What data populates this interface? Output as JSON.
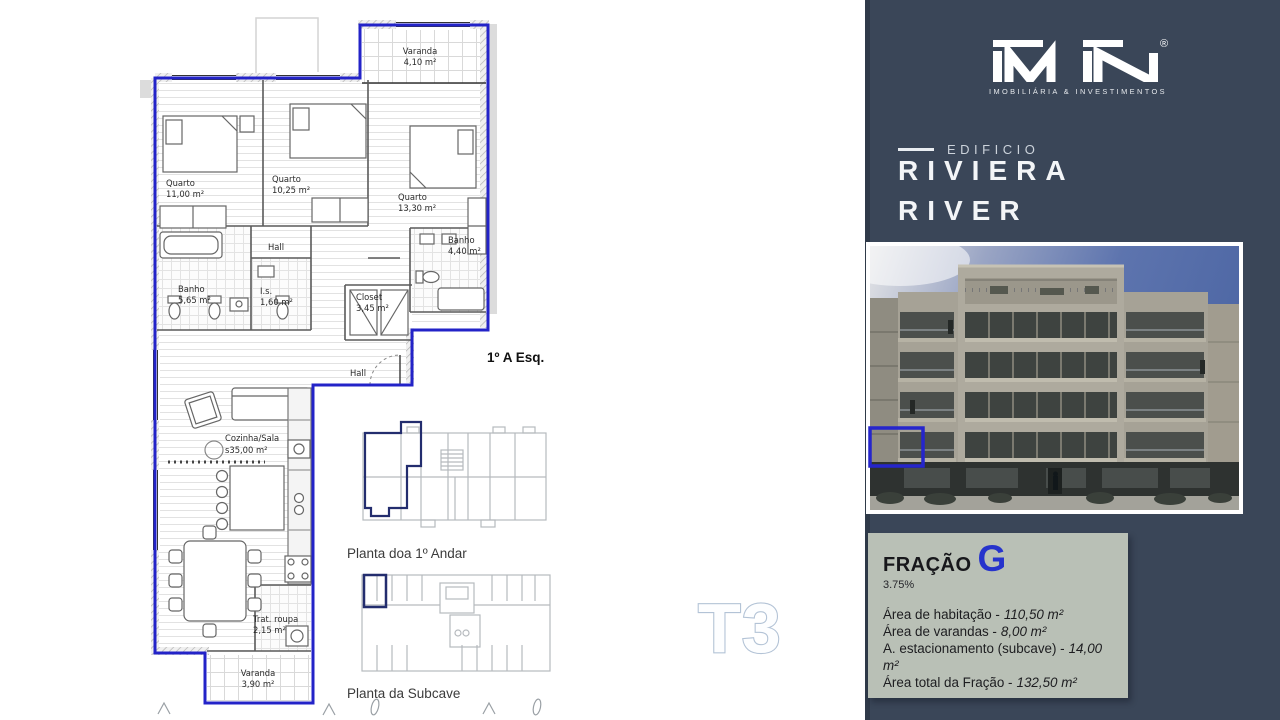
{
  "brand": {
    "logo_text": "iMiN",
    "registered_mark": "®",
    "tagline": "IMOBILIÁRIA & INVESTIMENTOS"
  },
  "building": {
    "label_prefix": "EDIFICIO",
    "name_line1": "RIVIERA",
    "name_line2": "RIVER"
  },
  "floor_plan": {
    "unit_label": "1º A Esq.",
    "type_watermark": "T3",
    "rooms": [
      {
        "name": "Varanda",
        "area": "4,10 m²"
      },
      {
        "name": "Quarto",
        "area": "11,00 m²"
      },
      {
        "name": "Quarto",
        "area": "10,25 m²"
      },
      {
        "name": "Quarto",
        "area": "13,30 m²"
      },
      {
        "name": "Hall",
        "area": ""
      },
      {
        "name": "Banho",
        "area": "4,40 m²"
      },
      {
        "name": "Banho",
        "area": "5,65 m²"
      },
      {
        "name": "I.s.",
        "area": "1,60 m²"
      },
      {
        "name": "Closet",
        "area": "3,45 m²"
      },
      {
        "name": "Hall",
        "area": ""
      },
      {
        "name": "Cozinha/Sala",
        "area": "s35,00 m²"
      },
      {
        "name": "Trat. roupa",
        "area": "2,15 m²"
      },
      {
        "name": "Varanda",
        "area": "3,90 m²"
      }
    ],
    "mini_plans": [
      {
        "caption": "Planta doa 1º Andar"
      },
      {
        "caption": "Planta da Subcave"
      }
    ]
  },
  "fraction": {
    "label": "FRAÇÃO",
    "letter": "G",
    "percentage": "3.75%",
    "areas": [
      {
        "label": "Área de habitação -",
        "value": "110,50 m²"
      },
      {
        "label": "Área de varandas -",
        "value": "8,00 m²"
      },
      {
        "label": "A. estacionamento (subcave) -",
        "value": "14,00 m²"
      },
      {
        "label": "Área total da Fração -",
        "value": "132,50 m²"
      }
    ]
  },
  "colors": {
    "panel_bg": "#3a4658",
    "panel_edge": "#2f3a49",
    "plan_outline_blue": "#2323c8",
    "mini_plan_highlight_navy": "#232d6e",
    "fraction_card_bg": "#b9c0b6",
    "fraction_letter_blue": "#2633cc",
    "watermark_fill": "#fdfeff",
    "watermark_outline": "#b3c3d6"
  }
}
